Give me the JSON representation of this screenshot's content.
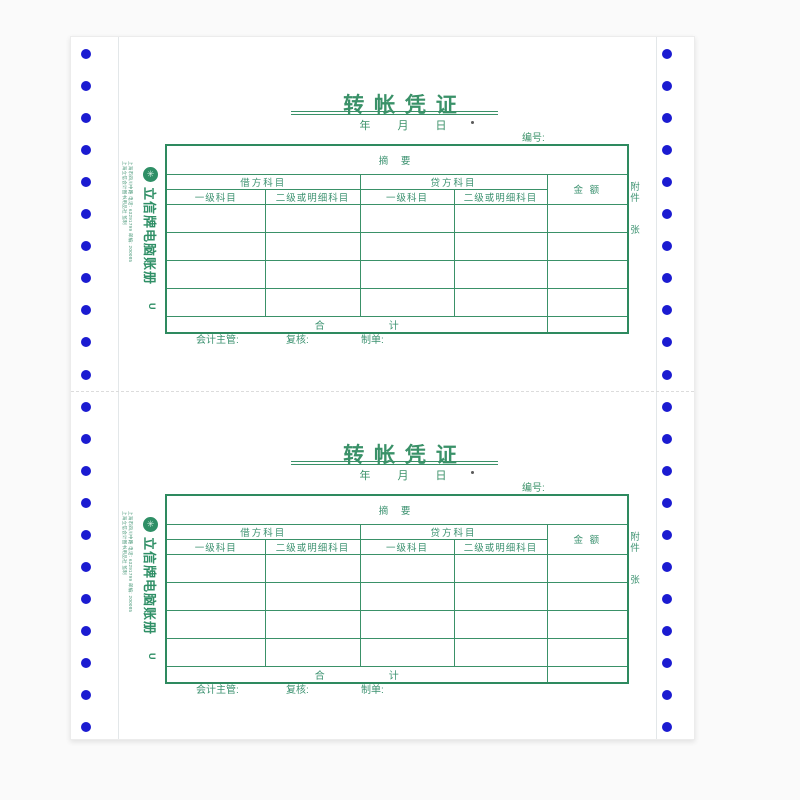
{
  "page": {
    "background": "#fafafa",
    "paper_color": "#ffffff",
    "accent_green": "#3a9168",
    "border_green": "#2e8a5f",
    "hole_blue": "#1b1bd1"
  },
  "tractor": {
    "holes_per_side": 22,
    "hole_color": "#1b1bd1"
  },
  "form": {
    "title": "转 帐 凭 证",
    "date_line": "年 月 日",
    "number_label": "编号:",
    "summary_label": "摘 要",
    "debit_header": "借方科目",
    "credit_header": "贷方科目",
    "level1_label": "一级科目",
    "level2_label": "二级或明细科目",
    "amount_label": "金 额",
    "attachment_label": "附件",
    "attachment_unit": "张",
    "total_left": "合",
    "total_right": "计",
    "sign_supervisor": "会计主管:",
    "sign_reviewer": "复核:",
    "sign_preparer": "制单:",
    "brand_name": "立信牌电脑账册",
    "brand_mark": "U",
    "brand_logo_glyph": "✳",
    "publisher_line1": "上海立信会计图书用品社 监制",
    "publisher_line2": "上海市四川中路 电话: 63291799 邮编: 200085"
  }
}
